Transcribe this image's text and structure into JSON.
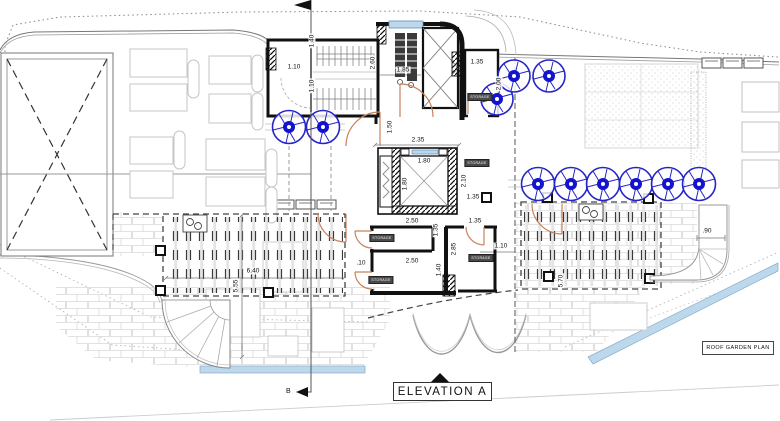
{
  "drawing": {
    "plan_label": "ROOF GARDEN PLAN",
    "elevation_label": "ELEVATION A",
    "section_marker": "B",
    "storage_label": "STORAGE"
  },
  "dimensions": {
    "stair_side_room_width": "1.10",
    "stair_flight_upper_width": "1.40",
    "stair_flight_lower_width": "1.10",
    "stair_well_depth": "2.60",
    "corridor_width": "1.85",
    "ne_room_width": "1.35",
    "ne_room_depth": "2.00",
    "lobby_width": "1.50",
    "lift_shaft_width": "2.35",
    "lift_cab_width": "1.80",
    "lift_cab_depth": "1.80",
    "lift_side_depth": "2.10",
    "lift_side_width": "1.35",
    "storage_top_width": "2.50",
    "storage_top_gap": "1.35",
    "storage_top_depth": "1.35",
    "storage_right_depth": "2.85",
    "storage_bottom_width": "2.50",
    "storage_bottom_depth": "1.40",
    "terrace_east_gap": "1.10",
    "pergola_west_gap": ".10",
    "pergola_left_width": "6.40",
    "pergola_left_depth": "5.55",
    "walkway_width": ".90",
    "pergola_right_depth": "5.70"
  },
  "colors": {
    "wall": "#111111",
    "door": "#c8825a",
    "tree": "#1c1cc8",
    "water": "#bdd7eb",
    "brick_line": "#d9d9d9"
  }
}
